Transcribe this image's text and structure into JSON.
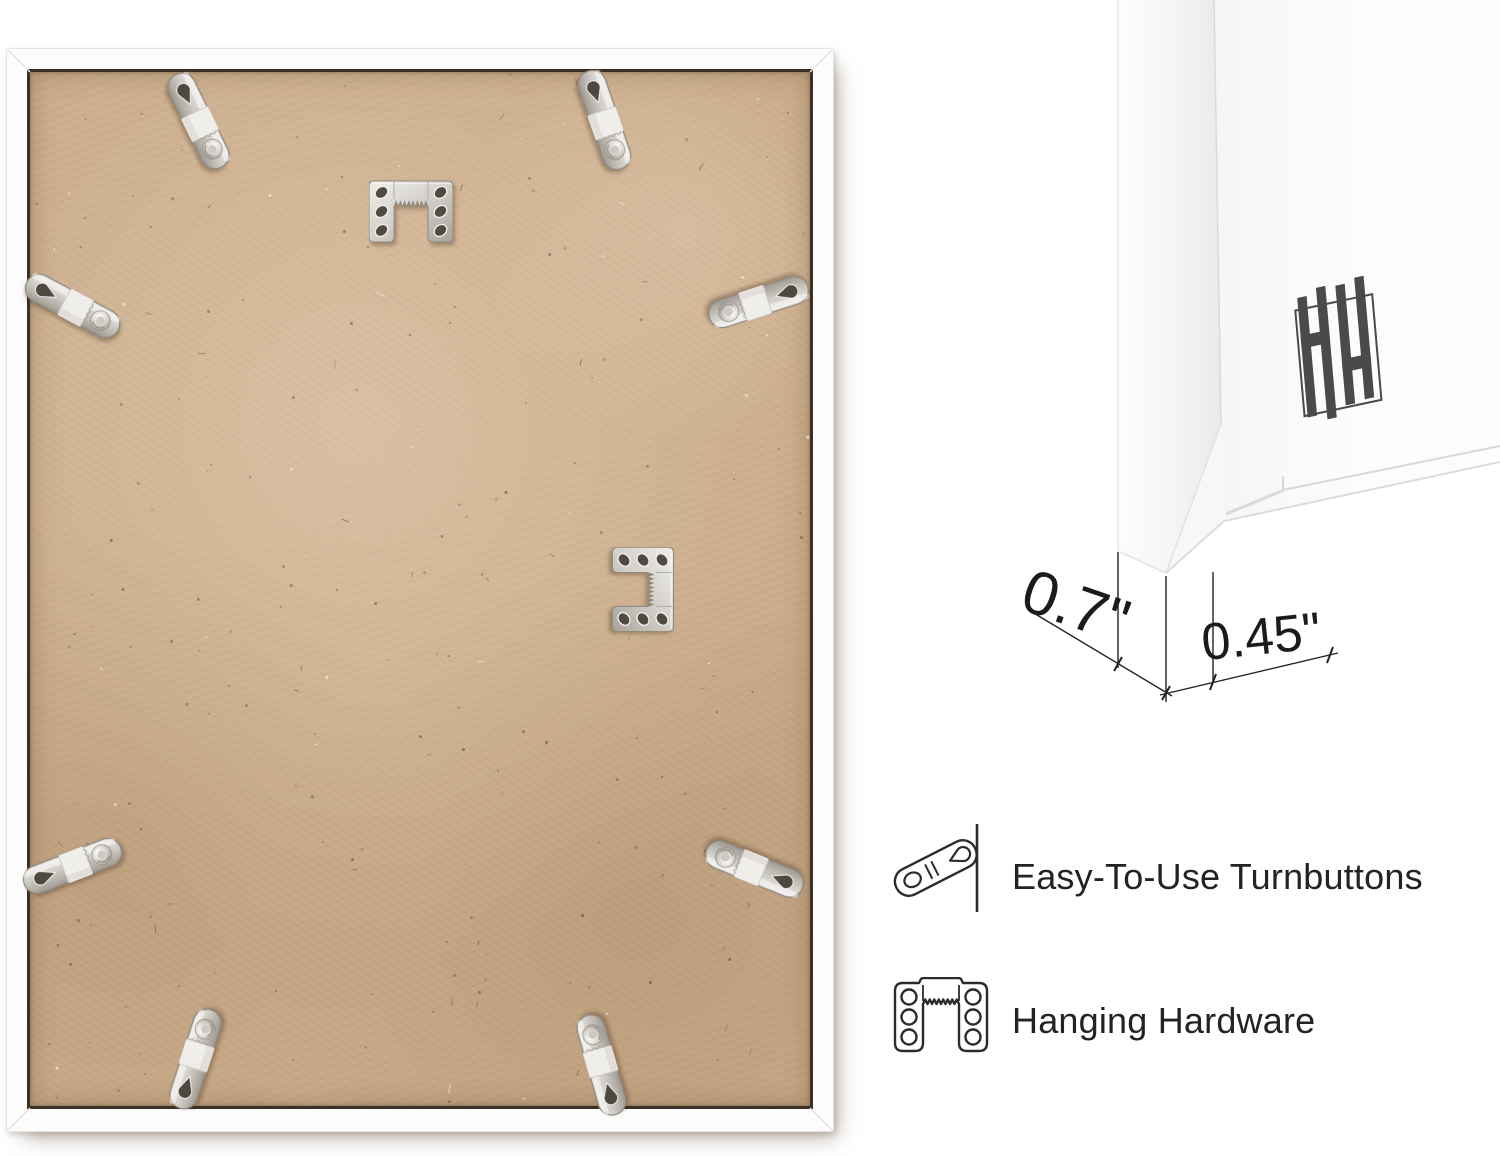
{
  "page": {
    "background": "#ffffff"
  },
  "product_photo": {
    "subject": "Back of white picture frame with MDF backing board",
    "frame_color": "#fcfcfc",
    "board_color": "#c9aa88",
    "hardware_color": "#cfccc6",
    "turnbutton_count": 8,
    "sawtooth_hanger_count": 2
  },
  "corner_closeup": {
    "subject": "White frame front corner close-up",
    "logo_monogram": "HH",
    "logo_color": "#4a4a4a",
    "dimensions": {
      "depth_label": "0.7\"",
      "face_label": "0.45\""
    }
  },
  "features": [
    {
      "icon": "turnbutton-icon",
      "label": "Easy-To-Use Turnbuttons"
    },
    {
      "icon": "hanging-hardware-icon",
      "label": "Hanging Hardware"
    }
  ]
}
